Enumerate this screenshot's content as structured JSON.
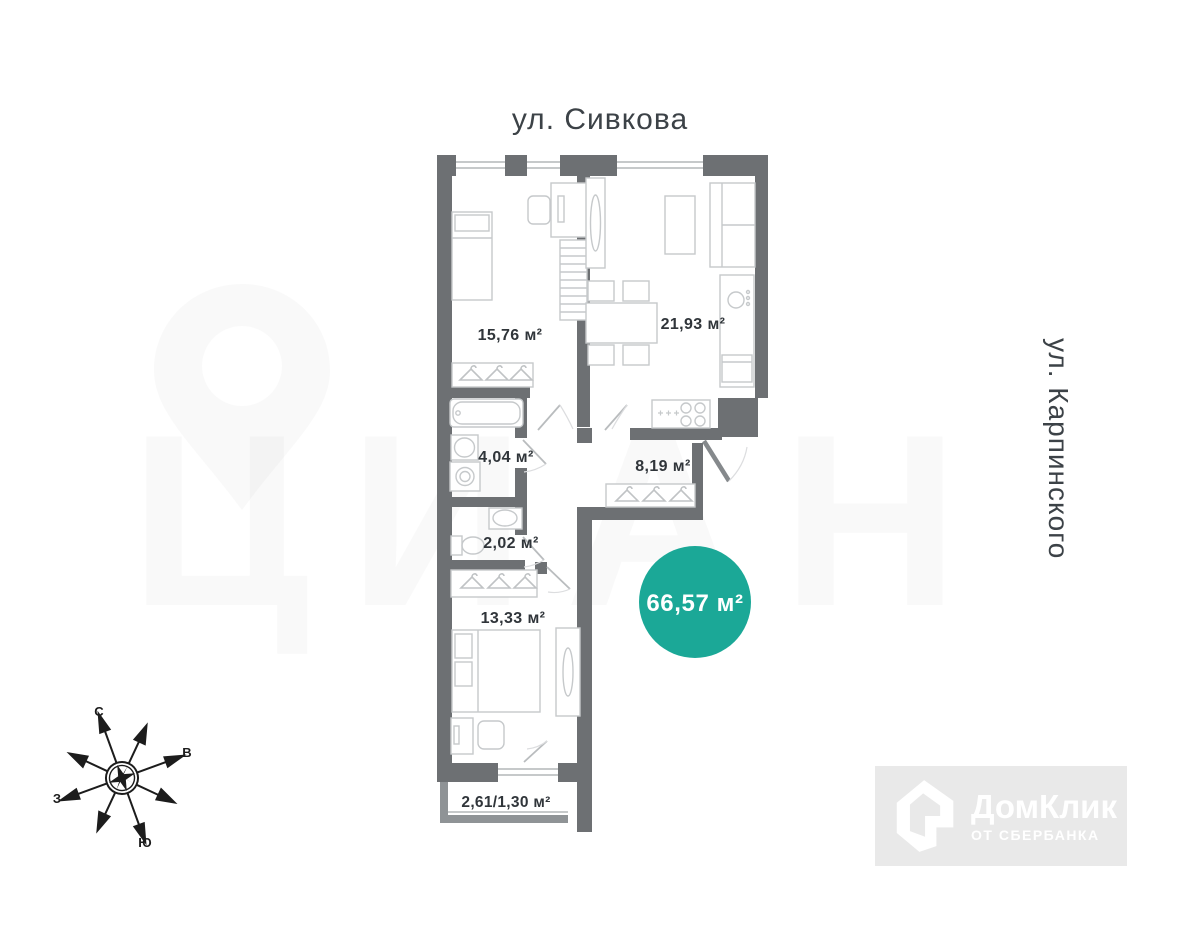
{
  "streets": {
    "top": "ул. Сивкова",
    "right": "ул. Карпинского"
  },
  "areas": {
    "bedroom1": "15,76 м²",
    "living_kitchen": "21,93 м²",
    "bathroom": "4,04 м²",
    "hallway": "8,19 м²",
    "wc": "2,02 м²",
    "bedroom2": "13,33 м²",
    "balcony": "2,61/1,30 м²",
    "total": "66,57 м²"
  },
  "compass": {
    "north": "С",
    "east": "В",
    "south": "Ю",
    "west": "З"
  },
  "logo": {
    "title": "ДомКлик",
    "subtitle": "ОТ СБЕРБАНКА"
  },
  "watermark": {
    "brand": "ЦИАН"
  },
  "colors": {
    "wall": "#6d7073",
    "balcony_wall": "#8f9396",
    "accent_circle": "#1ba897",
    "label_text": "#30353a",
    "street_text": "#3c4247",
    "logo_bg": "#e9e9e9",
    "logo_text": "#ffffff",
    "furniture_line": "#c6c9cb"
  }
}
